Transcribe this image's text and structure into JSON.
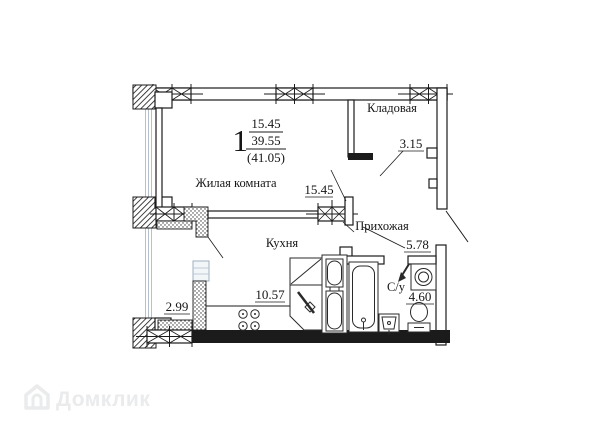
{
  "watermark": {
    "brand": "Домклик"
  },
  "header": {
    "rooms_count": "1",
    "living_area": "15.45",
    "total_area": "39.55",
    "area_with_balcony": "(41.05)"
  },
  "rooms": {
    "living": {
      "name": "Жилая комната",
      "area": "15.45"
    },
    "storage": {
      "name": "Кладовая",
      "area": "3.15"
    },
    "hallway": {
      "name": "Прихожая",
      "area": "5.78"
    },
    "kitchen": {
      "name": "Кухня",
      "area": "10.57"
    },
    "bathroom": {
      "name": "С/у",
      "area": "4.60"
    },
    "balcony": {
      "area": "2.99"
    }
  },
  "colors": {
    "line": "#1b1b1b",
    "glazing": "#b4c0cc",
    "watermark": "#e9ebed"
  }
}
